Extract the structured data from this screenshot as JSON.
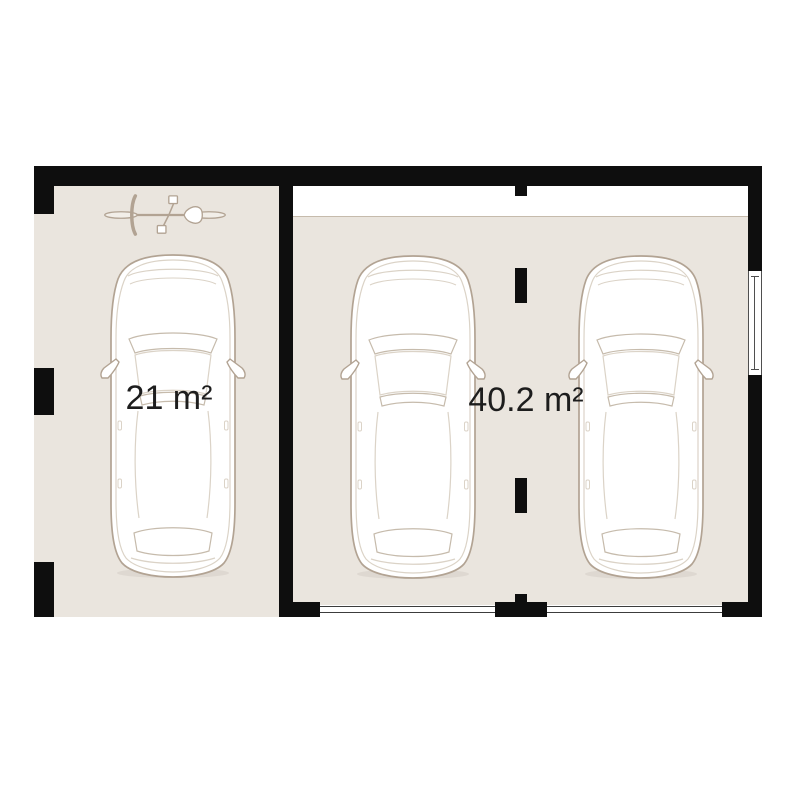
{
  "rooms": [
    {
      "name": "left-garage-bay",
      "area_label": "21 m²",
      "items": [
        "bicycle-icon",
        "car-icon"
      ]
    },
    {
      "name": "right-garage",
      "area_label": "40.2 m²",
      "items": [
        "car-icon",
        "car-icon"
      ]
    }
  ],
  "colors": {
    "bg": "#ffffff",
    "wall": "#0e0e0e",
    "floor": "#eae5de",
    "outline": "#b2a393",
    "outline_light": "#dbd3c7",
    "band": "#c6bbac",
    "label": "#1d1d1d",
    "door_line": "#3c3c3c",
    "window_line": "#4f4f4f"
  }
}
